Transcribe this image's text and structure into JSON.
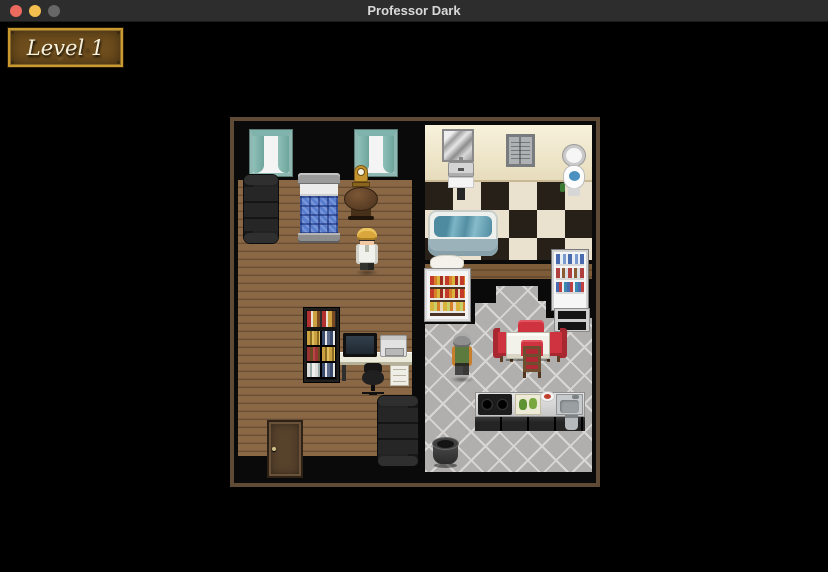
{
  "window": {
    "title": "Professor Dark"
  },
  "hud": {
    "level_label": "Level 1"
  },
  "theme": {
    "titlebar-bg": "#2d2d2d",
    "titlebar-text": "#d9d9d9",
    "stage-bg": "#000000",
    "light-close": "#ed6a5e",
    "light-min": "#f4bf4f",
    "light-zoom": "#676767",
    "map-frame": "#5e4a35",
    "wall-gray": "#c7c6c4",
    "wall-cream": "#f1e9cf",
    "checker-dark": "#272019",
    "checker-light": "#eae2cf",
    "kitchen-tile": "#b0afad",
    "kitchen-tile-line": "#d8d7d5",
    "curtain-teal": "#7fb3ab",
    "water-blue": "#4a90c0",
    "quilt-blue": "#5b7fd0",
    "chair-red": "#cf3340",
    "plaque-bg": "#6f4e1d",
    "plaque-border": "#c9992f",
    "plaque-text": "#f7f2dd"
  },
  "scene": {
    "rooms": [
      "bedroom-living-room",
      "bathroom",
      "kitchen"
    ],
    "objects": [
      "curtained-window",
      "curtained-window",
      "leather-couch",
      "bed",
      "round-table",
      "mantel-clock",
      "mirror",
      "shuttered-window",
      "toilet",
      "wall-sink",
      "bathtub",
      "bath-mat",
      "bath-mat",
      "bookshelf",
      "computer-monitor",
      "printer",
      "desk",
      "office-chair",
      "wooden-door",
      "leather-couch",
      "display-fridge",
      "dish-cabinet",
      "dining-table",
      "red-chair",
      "red-chair",
      "red-chair",
      "red-chair",
      "kitchen-counter",
      "stove",
      "cutting-board",
      "food-plate",
      "counter-sink",
      "counter-drawers",
      "towel",
      "cooking-pot"
    ],
    "characters": [
      "professor",
      "old-man"
    ]
  }
}
